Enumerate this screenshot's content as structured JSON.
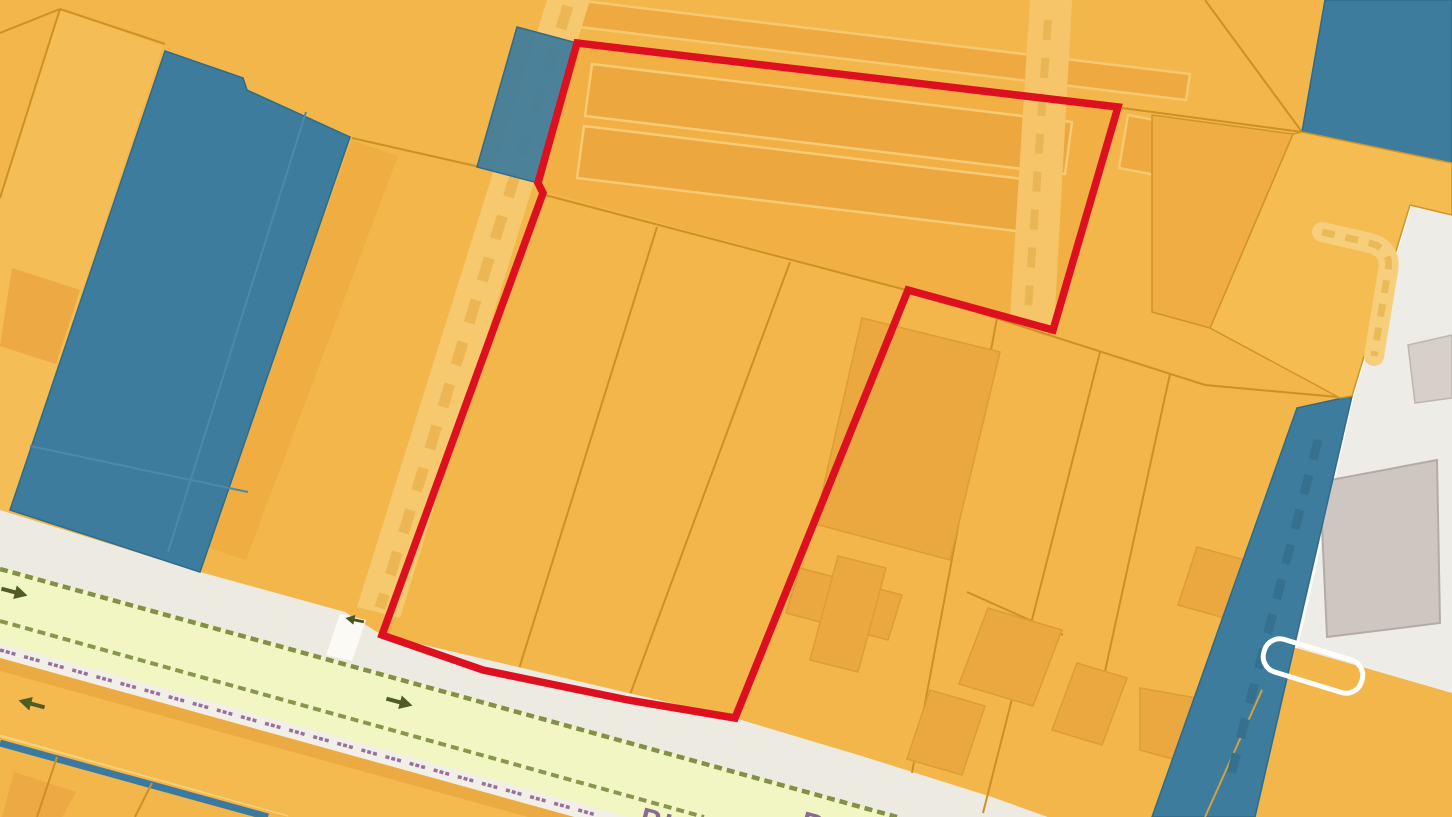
{
  "map": {
    "road_labels": {
      "fragment_1": "PIA",
      "fragment_2": "R"
    },
    "colors": {
      "parcel_orange": "#f3b64b",
      "parcel_orange_light": "#f5bd55",
      "parcel_orange_dark": "#efad42",
      "building_orange": "#eca73e",
      "building_outline_light": "#f7cb74",
      "boundary_line": "#cd9025",
      "zone_blue": "#3d7c9c",
      "zone_blue_edge": "#2e6b8c",
      "selection_red": "#de1020",
      "sidewalk_gray": "#edeae2",
      "road_pale_green": "#f1f6c3",
      "road_edge_olive": "#6f8030",
      "median_orange": "#f4ba50",
      "address_strip_white": "#f2efe6",
      "address_marks_purple": "#96719f",
      "area_gray": "#edece7",
      "building_gray": "#cdc6c1",
      "path_light": "#f6c96f",
      "arrow_olive": "#515c25",
      "crossing_white": "#fbfaf4"
    },
    "icons": {
      "arrow_lane_1": "one-way-right-arrow",
      "arrow_lane_2": "one-way-right-arrow",
      "arrow_median": "one-way-left-arrow",
      "arrow_crossing": "small-left-arrow"
    }
  }
}
